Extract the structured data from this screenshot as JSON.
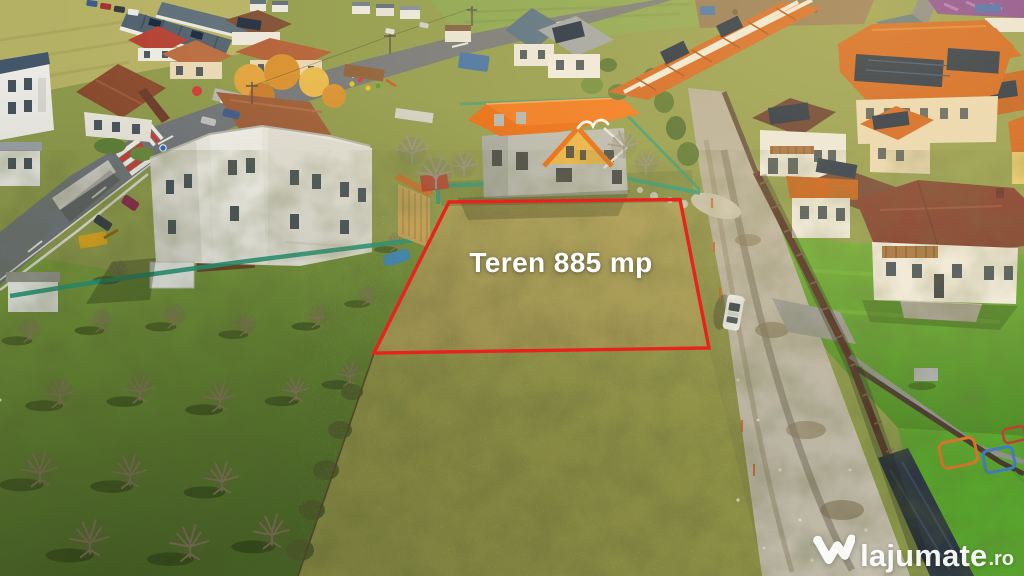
{
  "overlay": {
    "plot_label": "Teren 885 mp",
    "outline_color": "#e8231d",
    "label_color": "#ffffff"
  },
  "watermark": {
    "brand": "lajumate",
    "tld": ".ro",
    "logo_icon": "lajumate-w-logo",
    "color": "#ffffff"
  },
  "palette": {
    "plot_grass": "#a8a258",
    "orchard_green": "#6f9138",
    "lawn_green": "#61a22f",
    "asphalt": "#70747a",
    "gravel": "#bdb6a8",
    "roof_orange": "#d2601c",
    "roof_dark_red": "#7c352a",
    "solar_panel": "#16253f",
    "mesh_fence": "#23997c",
    "construction_roof": "#e8670f"
  }
}
